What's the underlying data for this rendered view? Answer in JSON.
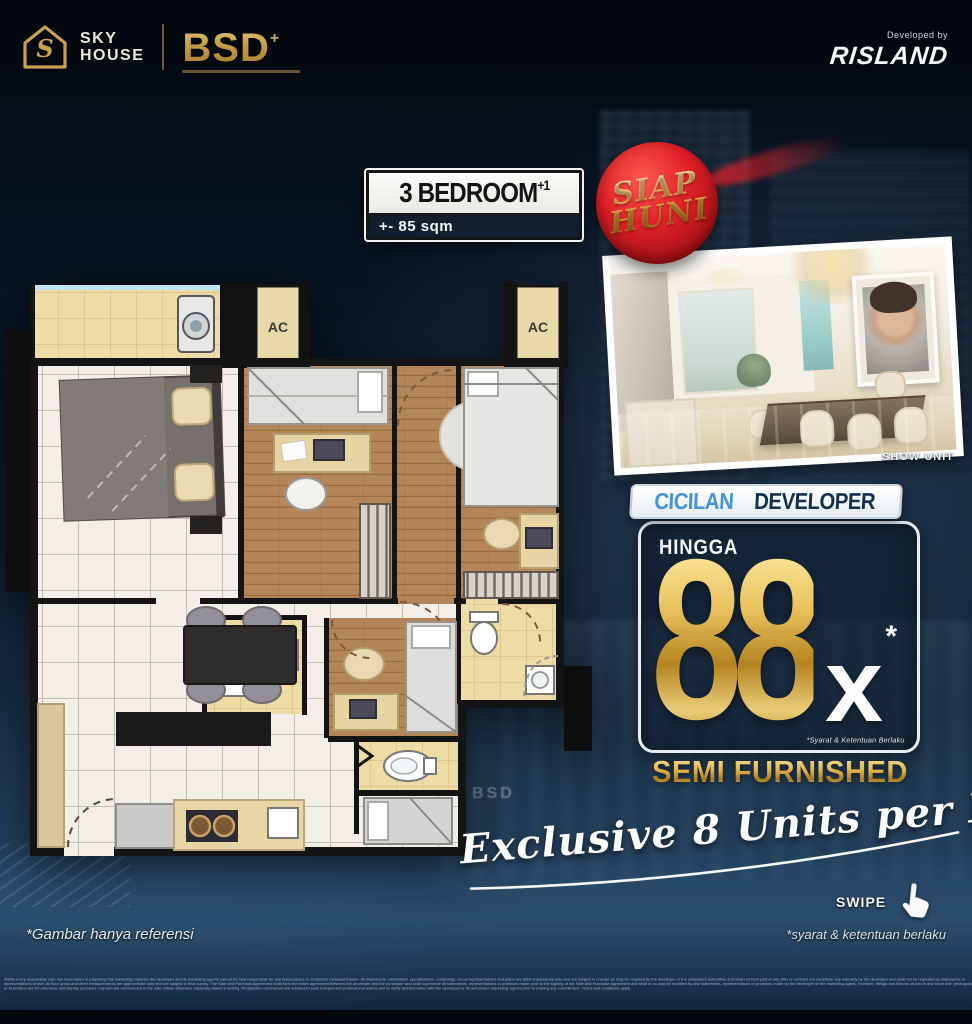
{
  "header": {
    "logo_monogram": "S",
    "brand_line1": "SKY",
    "brand_line2": "HOUSE",
    "brand_secondary": "BSD",
    "brand_secondary_plus": "+",
    "developed_by_label": "Developed by",
    "developer_name": "RISLAND"
  },
  "unit": {
    "type": "3 BEDROOM",
    "type_suffix": "+1",
    "area": "+- 85 sqm"
  },
  "badge": {
    "line1": "SIAP",
    "line2": "HUNI"
  },
  "show_unit": {
    "caption": "SHOW UNIT"
  },
  "offer": {
    "header_word1": "CICILAN",
    "header_word2": "DEVELOPER",
    "upto_label": "HINGGA",
    "installments_value": "88",
    "installments_times": "x",
    "asterisk": "*",
    "terms_note": "*Syarat & Ketentuan Berlaku"
  },
  "furnishing": "SEMI FURNISHED",
  "exclusivity": "Exclusive 8 Units per Floor",
  "swipe_label": "SWIPE",
  "footnotes": {
    "image_reference": "*Gambar hanya referensi",
    "terms": "*syarat & ketentuan berlaku"
  },
  "floorplan": {
    "ac_label": "AC"
  },
  "background": {
    "watermark": "BSD"
  },
  "colors": {
    "gold": "#d9a843",
    "badge_red": "#c4161c",
    "blue": "#4593d8",
    "navy": "#132f4e",
    "tile_tan": "#eedca6",
    "wood": "#b5855a"
  },
  "fine_print": "Whilst every reasonable care has been taken in preparing this marketing material, the developer and its marketing agents cannot be held responsible for any inaccuracies or omissions contained herein. All statements, information, specifications, renderings, visual representations and plans are artist impressions only and are subject to change as may be required by the developer or the competent authorities and shall not form part of any offer or contract nor constitute any warranty by the developer and shall not be regarded as statements or representations of fact. All floor areas and other measurements are approximate only and are subject to final survey. The Sale and Purchase Agreement shall form the entire agreement between the developer and the purchaser and shall supersede all statements, representations or promises made prior to the signing of the Sale and Purchase Agreement and shall in no way be modified by any statements, representations or promises made by the developer or the marketing agent. Furniture, fittings and fixtures shown in any show unit, photograph or illustration are for reference and display purposes only and are not included in the sale unless otherwise expressly stated in writing. Prospective purchasers are advised to seek independent professional advice and to verify all information with the developer or its authorised marketing agents prior to making any commitment. Terms and conditions apply."
}
